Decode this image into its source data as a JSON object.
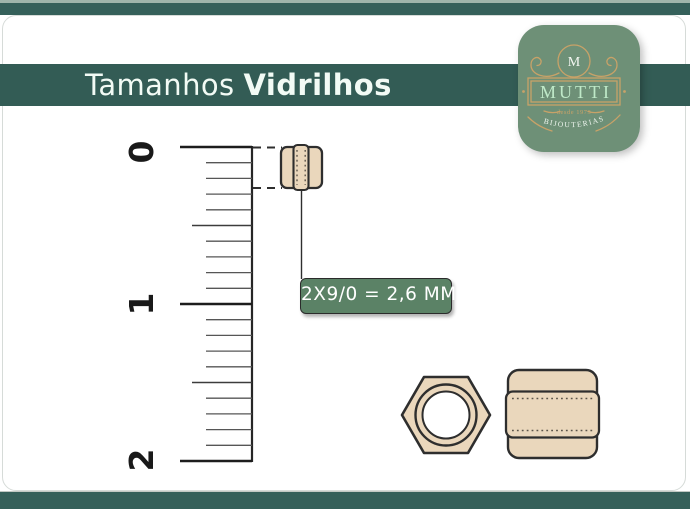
{
  "header": {
    "title_regular": "Tamanhos",
    "title_bold": "Vidrilhos"
  },
  "logo": {
    "monogram": "M",
    "brand": "MUTTI",
    "tagline": "desde 1973",
    "subtitle": "BIJOUTERIAS"
  },
  "ruler": {
    "unit_labels": [
      "0",
      "1",
      "2"
    ],
    "minor_divisions_per_unit": 10
  },
  "annotation": {
    "size_label": "2X9/0 = 2,6 MM"
  },
  "icons": {
    "bead_ruler": "bugle-bead-on-ruler-icon",
    "bead_front": "bugle-bead-front-view-icon",
    "bead_side": "bugle-bead-side-view-icon",
    "monogram": "brand-monogram-icon"
  },
  "colors": {
    "bar_green": "#35605A",
    "band_green": "#335C55",
    "label_green": "#5B8266",
    "logo_green": "#6E9077",
    "gold": "#C8A268",
    "mint_text": "#BFE9C8",
    "title_text": "#F2FBF5",
    "bead_fill": "#EAD7BC",
    "outline_dark": "#2E2E2E",
    "edge_light": "#9FB5AB"
  }
}
